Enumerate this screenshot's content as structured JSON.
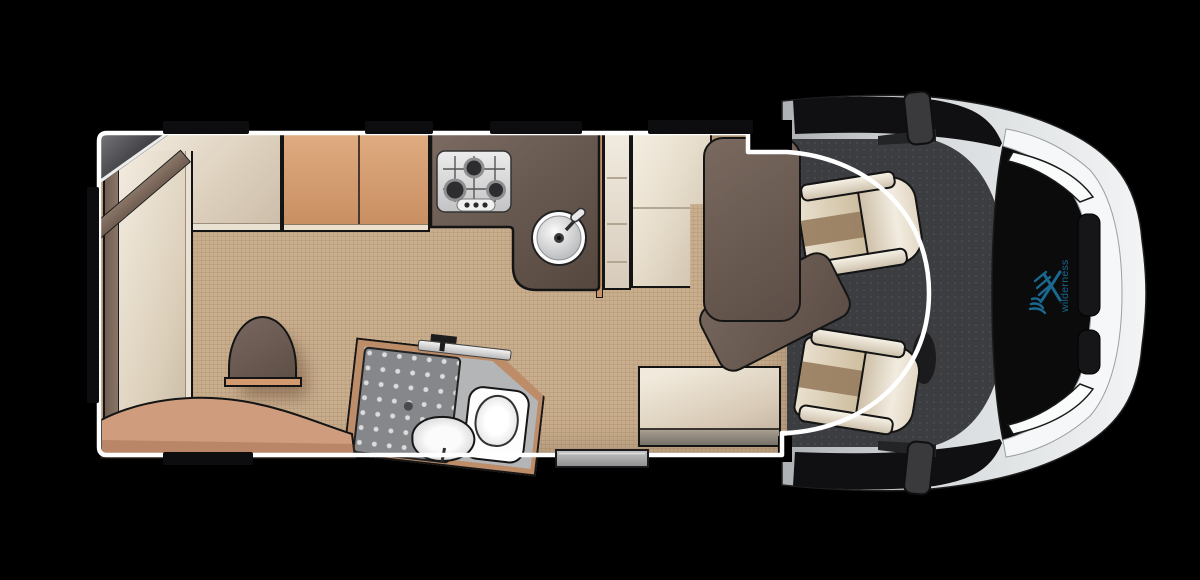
{
  "logo": {
    "text": "wilderness",
    "color": "#19688f"
  },
  "colors": {
    "background": "#000000",
    "body_outline": "#ffffff",
    "floor": "#c9ae8e",
    "cab_floor": "#3c3d40",
    "counter": "#60524a",
    "cabinet": "#d29c72",
    "upholstery": "#e9e1d3",
    "table": "#6a5b53",
    "accent_wood": "#c9946c",
    "bathroom_wall": "#bd8d69",
    "vehicle_body": "#e4e6e8",
    "window": "#0d0d0f"
  },
  "components": [
    "rear-lounge-seat",
    "pedestal-table",
    "curved-bench",
    "tv-corner",
    "kitchen-cabinets",
    "gas-hob",
    "kitchen-sink",
    "shelf-unit",
    "wardrobe",
    "dinette-table",
    "bench-seat",
    "bathroom",
    "shower-tray",
    "wash-basin",
    "toilet",
    "entry-step",
    "passenger-seat",
    "driver-seat",
    "steering-wheel",
    "windscreen",
    "wing-mirrors",
    "brand-logo"
  ]
}
